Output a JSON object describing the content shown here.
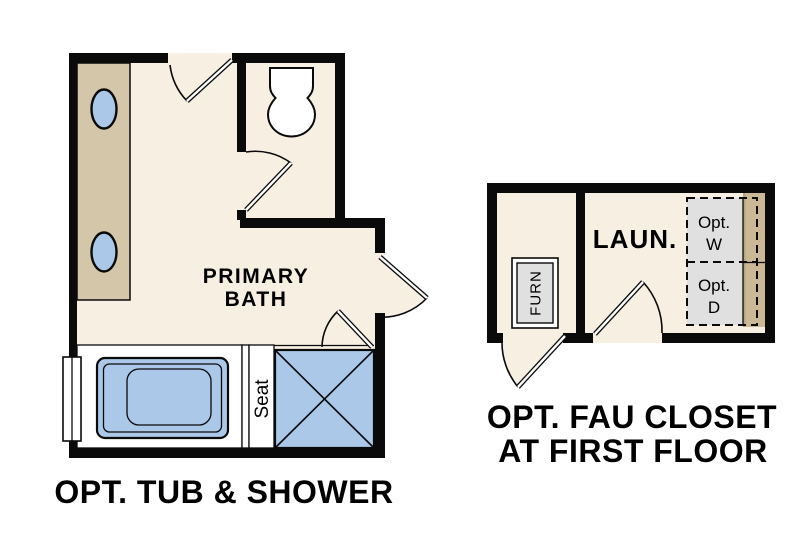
{
  "plan_type": "floor-plan",
  "colors": {
    "wall_black": "#0a0a0a",
    "floor_cream": "#f6efe2",
    "fixture_blue": "#abc8e8",
    "vanity_tan": "#d3c6a9",
    "counter_tan": "#cbb996",
    "counter_edge_tan": "#b7a47e",
    "appliance_gray": "#e0e0e0",
    "background": "#ffffff"
  },
  "bath": {
    "room_label_line1": "PRIMARY",
    "room_label_line2": "BATH",
    "seat_label": "Seat",
    "caption": "OPT. TUB & SHOWER",
    "fixtures": [
      "vanity-with-2-sinks",
      "toilet",
      "bathtub",
      "shower-with-seat",
      "window"
    ]
  },
  "laundry": {
    "room_label": "LAUN.",
    "furnace_label": "FURN",
    "washer_label_line1": "Opt.",
    "washer_label_line2": "W",
    "dryer_label_line1": "Opt.",
    "dryer_label_line2": "D",
    "caption_line1": "OPT. FAU CLOSET",
    "caption_line2": "AT FIRST FLOOR",
    "fixtures": [
      "furnace",
      "optional-washer",
      "optional-dryer",
      "counter"
    ]
  }
}
